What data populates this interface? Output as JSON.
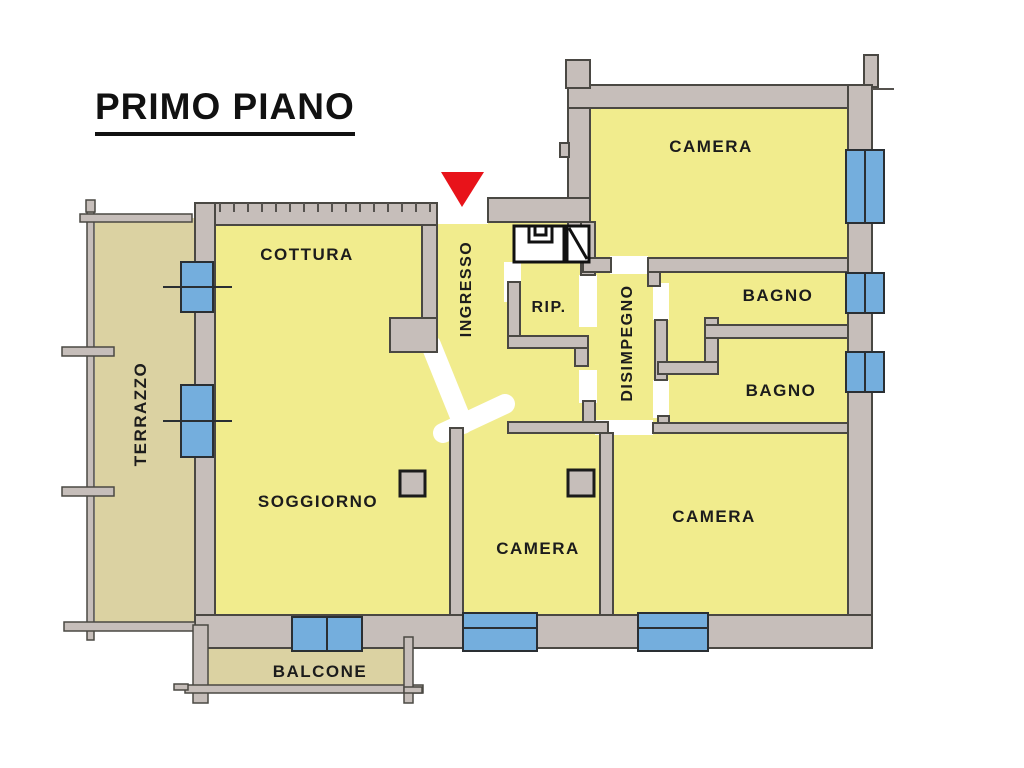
{
  "title": {
    "text": "PRIMO PIANO"
  },
  "rooms": {
    "cottura": {
      "label": "COTTURA"
    },
    "ingresso": {
      "label": "INGRESSO"
    },
    "rip": {
      "label": "RIP."
    },
    "disimpegno": {
      "label": "DISIMPEGNO"
    },
    "bagno_1": {
      "label": "BAGNO"
    },
    "bagno_2": {
      "label": "BAGNO"
    },
    "camera_top": {
      "label": "CAMERA"
    },
    "camera_mid": {
      "label": "CAMERA"
    },
    "camera_right": {
      "label": "CAMERA"
    },
    "soggiorno": {
      "label": "SOGGIORNO"
    },
    "terrazzo": {
      "label": "TERRAZZO"
    },
    "balcone": {
      "label": "BALCONE"
    }
  },
  "icons": {
    "entrance_marker": "red-downward-triangle"
  },
  "colors": {
    "room_fill": "#f1ec8d",
    "outdoor_fill": "#dbd2a2",
    "wall_fill": "#c6beba",
    "wall_line": "#4a4843",
    "window_fill": "#74aedd",
    "marker_red": "#e8131a",
    "text_color": "#1c1c1c"
  }
}
